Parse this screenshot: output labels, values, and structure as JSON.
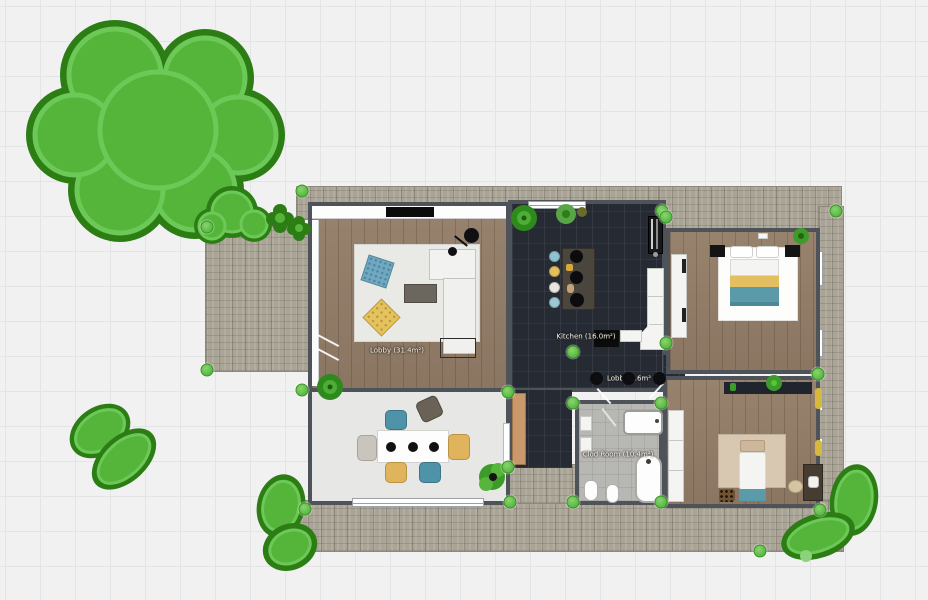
{
  "app": {
    "name": "floor-plan-editor",
    "view": "2d-plan"
  },
  "rooms": {
    "living": {
      "label": "Lobby (31.4m²)"
    },
    "kitchen": {
      "label": "Kitchen (16.0m²)"
    },
    "hall": {
      "label": "Lobby 3.6m²"
    },
    "bathroom": {
      "label": "Clod Room (10.4m²)"
    }
  },
  "palette": {
    "selection_handle": "#58b944",
    "wall": "#4d5359",
    "wood_floor": "#937d68",
    "kitchen_tile": "#262a33",
    "bathroom_tile": "#b7b7b3",
    "dining_floor": "#e7e7e5",
    "paver": "#a9a496",
    "tree_fill": "#55b43a",
    "tree_outline": "#2d7d15",
    "accent_teal": "#5b9aa8",
    "accent_yellow": "#e3bf62",
    "grid_line": "#e3e4e6",
    "canvas_bg": "#f1f1f2"
  },
  "objects": [
    "large-tree",
    "bushes",
    "shrubs",
    "sofa",
    "coffee-table",
    "floor-lamp",
    "tv",
    "rug",
    "dining-table",
    "dining-chairs",
    "kitchen-island",
    "bar-stools",
    "fridge",
    "counter",
    "double-bed",
    "nightstands",
    "wardrobe",
    "bathtub",
    "shower-tub",
    "toilet",
    "bidet",
    "single-bed",
    "desk",
    "desk-chair",
    "plants",
    "ceiling-lamps"
  ]
}
